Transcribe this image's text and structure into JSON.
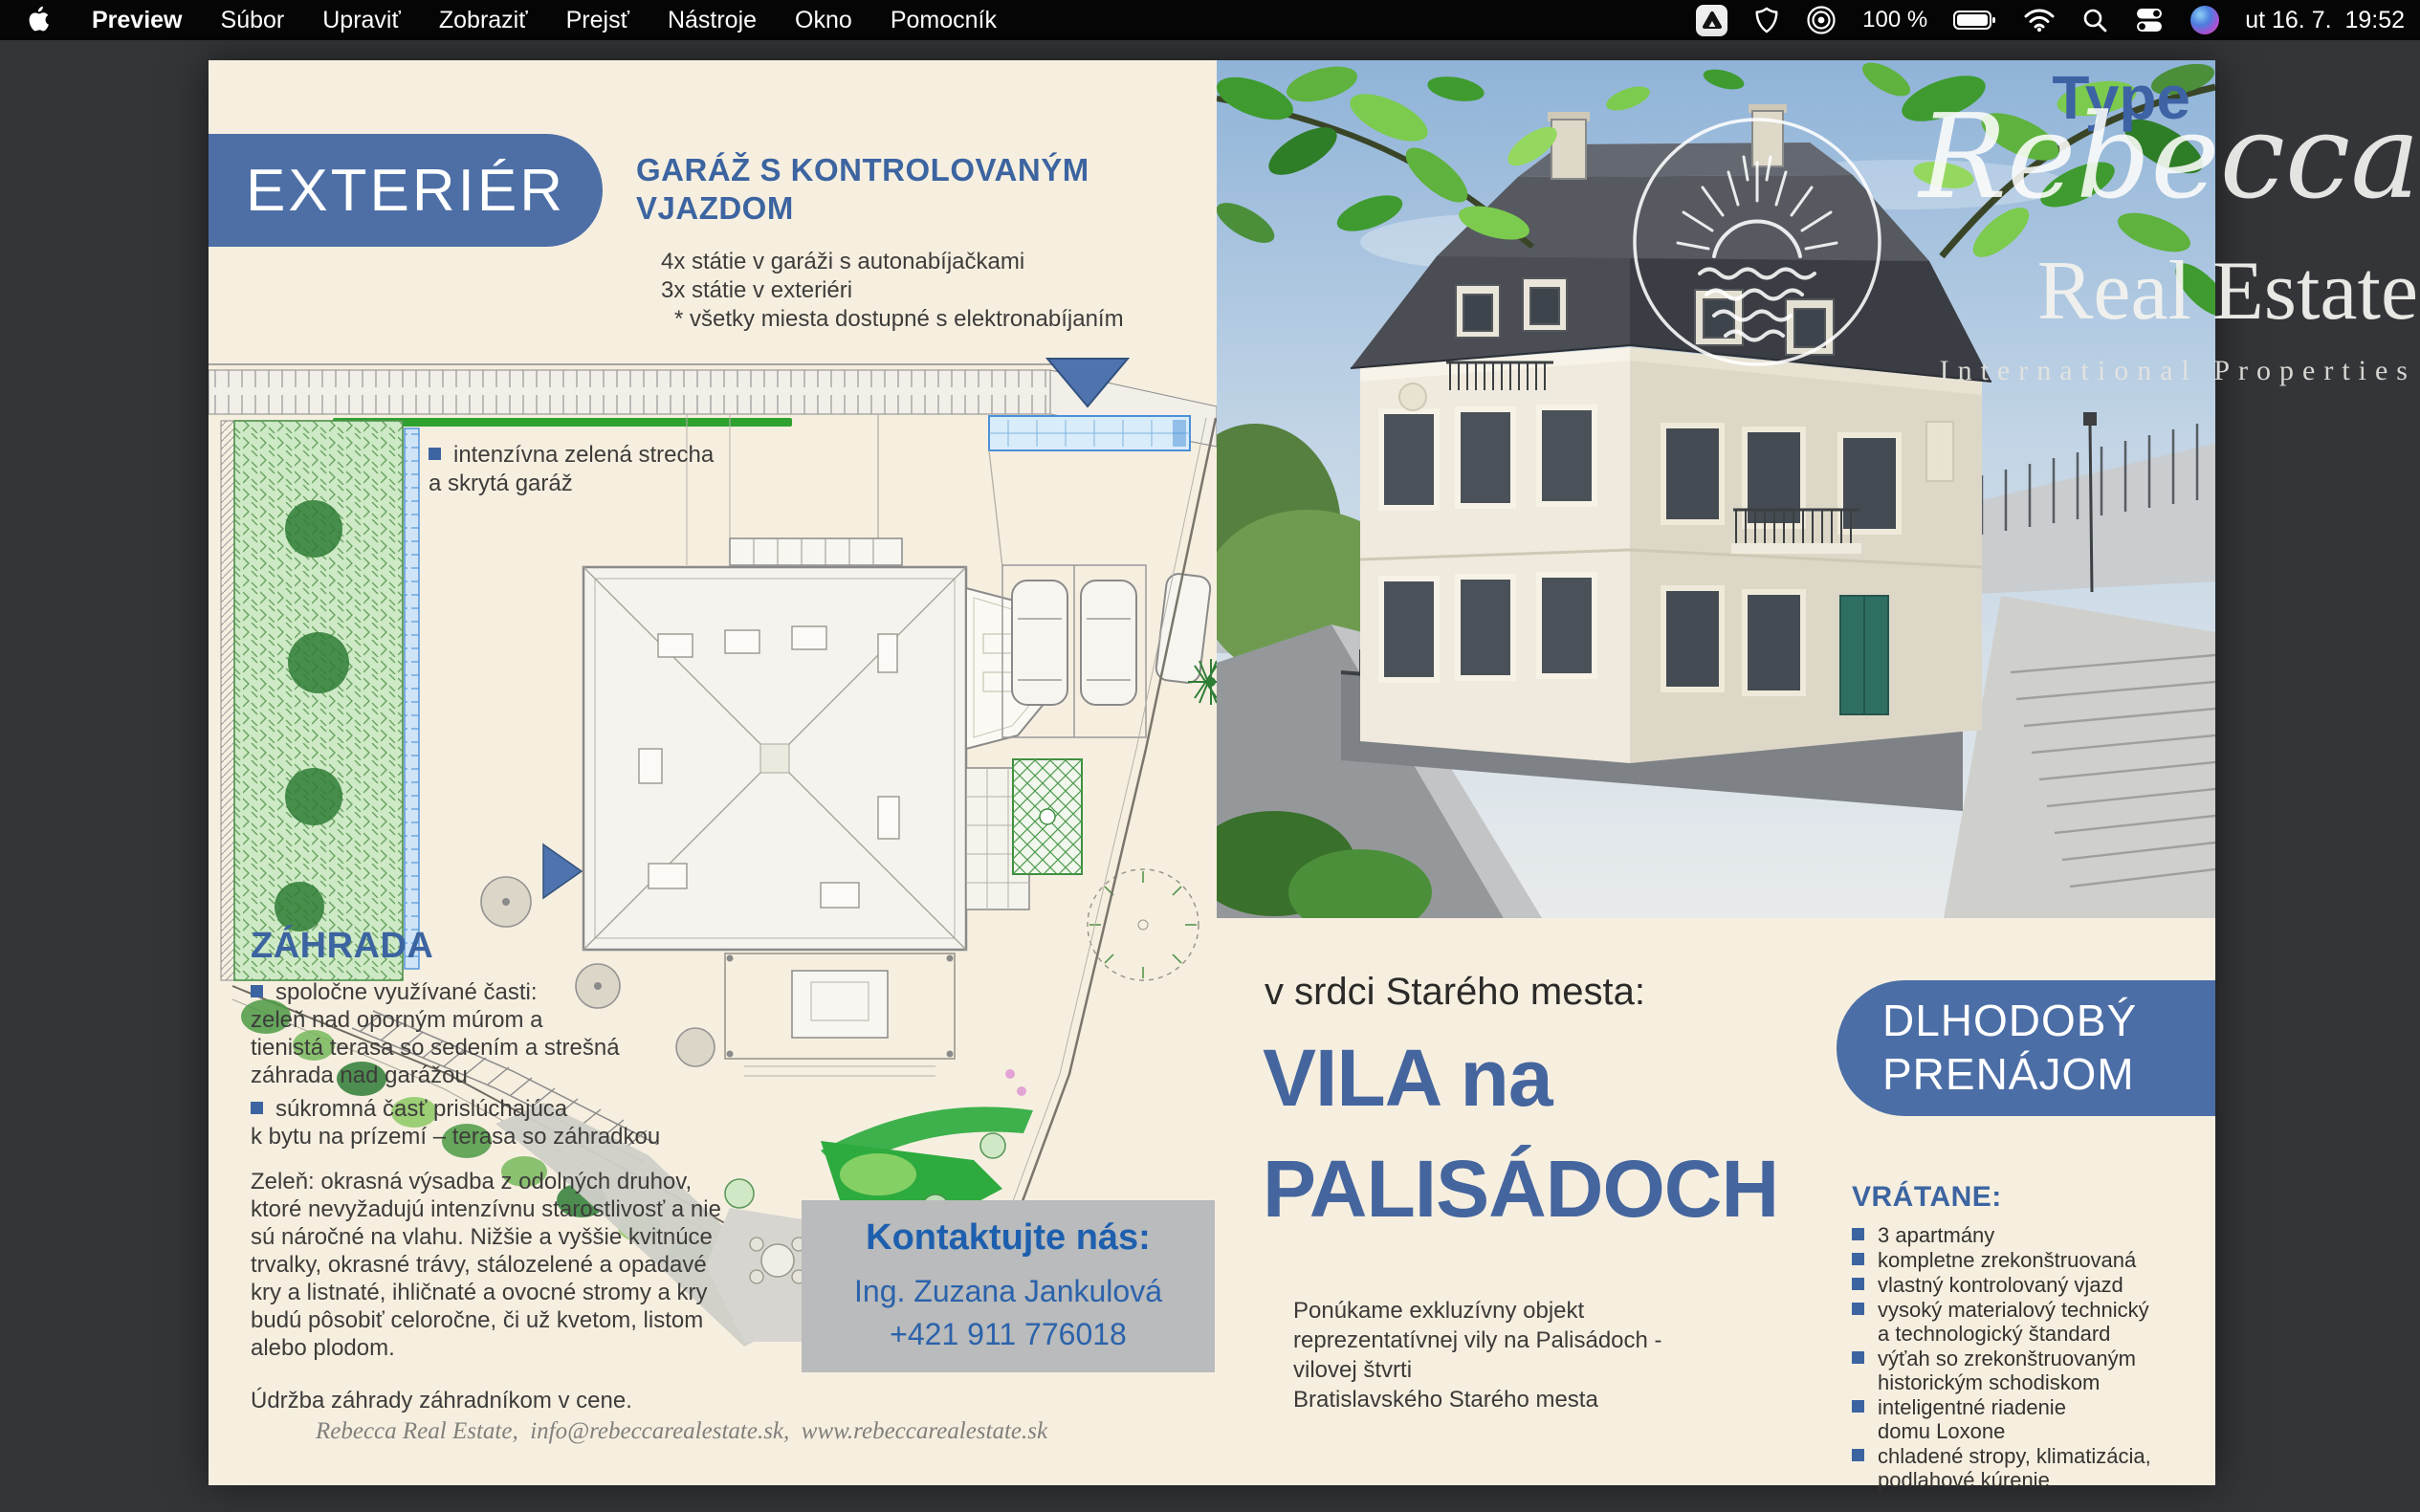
{
  "colors": {
    "desktop-gray": "#343538",
    "menubar-black": "#060606",
    "page-cream": "#f6efe0",
    "pill-blue": "#4d6fa6",
    "heading-blue": "#3c64a0",
    "banner-blue": "#4c6ea6",
    "brand-blue": "#45659e",
    "contact-gray": "#b9bbbc",
    "accent-green": "#2fa12f",
    "text-dark": "#3d3c3a"
  },
  "menu_bar": {
    "app_name": "Preview",
    "items": [
      "Súbor",
      "Upraviť",
      "Zobraziť",
      "Prejsť",
      "Nástroje",
      "Okno",
      "Pomocník"
    ],
    "status": {
      "battery_percent": "100 %",
      "clock": "ut 16. 7.  19:52"
    }
  },
  "left_page": {
    "section_title": "EXTERIÉR",
    "garage_heading": "GARÁŽ S KONTROLOVANÝM\nVJAZDOM",
    "parking_lines": [
      "4x státie v garáži s autonabíjačkami",
      "3x státie v exteriéri",
      "* všetky miesta dostupné s elektronabíjaním"
    ],
    "green_roof_note": "intenzívna zelená strecha\na skrytá garáž",
    "garden": {
      "heading": "ZÁHRADA",
      "bullet1": "spoločne využívané časti:\nzeleň nad oporným múrom a\ntienistá terasa so sedením a strešná\nzáhrada nad garážou",
      "bullet2": "súkromná časť prislúchajúca\nk bytu na prízemí – terasa so záhradkou",
      "paragraph": "Zeleň: okrasná výsadba z odolných druhov,\nktoré nevyžadujú intenzívnu starostlivosť a nie\nsú náročné na vlahu. Nižšie a vyššie kvitnúce\ntrvalky, okrasné trávy, stálozelené a opadavé\nkry a listnaté, ihličnaté  a ovocné stromy a kry\nbudú pôsobiť celoročne, či už kvetom, listom\nalebo plodom.",
      "note": "Údržba záhrady záhradníkom v cene."
    },
    "contact": {
      "title": "Kontaktujte nás:",
      "name": "Ing. Zuzana Jankulová",
      "phone": "+421 911 776018"
    },
    "footer": "Rebecca Real Estate,  info@rebeccarealestate.sk,  www.rebeccarealestate.sk"
  },
  "right_page": {
    "logo": {
      "type_label": "Type",
      "brand_script": "Rebecca",
      "brand_serif": "Real Estate",
      "tagline": "International Properties"
    },
    "intro": "v srdci Starého mesta:",
    "title_line1": "VILA na",
    "title_line2": "PALISÁDOCH",
    "banner": "DLHODOBÝ\nPRENÁJOM",
    "description": "Ponúkame exkluzívny objekt\nreprezentatívnej vily na Palisádoch -\nvilovej štvrti\nBratislavského Starého mesta",
    "included": {
      "heading": "VRÁTANE:",
      "items": [
        "3 apartmány",
        "kompletne zrekonštruovaná",
        "vlastný kontrolovaný vjazd",
        "vysoký materialový technický\na technologický štandard",
        "výťah so zrekonštruovaným\nhistorickým schodiskom",
        "inteligentné riadenie\ndomu Loxone",
        "chladené stropy, klimatizácia,\npodlahové kúrenie"
      ]
    }
  }
}
